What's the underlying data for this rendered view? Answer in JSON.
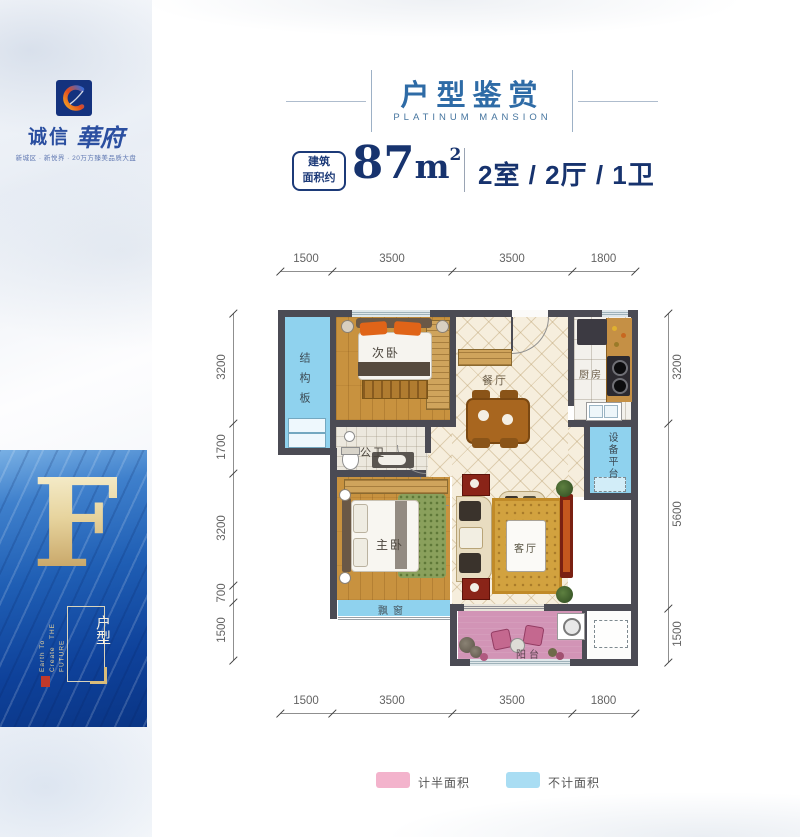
{
  "colors": {
    "navy_text": "#17336e",
    "header_blue": "#2e6ba6",
    "brand_blue": "#2b4fa0",
    "wall_gray": "#4b4b54",
    "room_blue": "#8fd2ee",
    "balcony_pink": "#d294b6",
    "legend_pink": "#f3b3cc",
    "legend_blue": "#a9ddf3",
    "gold": "#d9bc7a"
  },
  "sidebar": {
    "brand_cn_1": "诚信",
    "brand_cn_2": "華府",
    "tagline": "新城区 · 新悦界 · 20万方臻美品质大盘",
    "unit_letter": "F",
    "unit_label": "户型",
    "slogan_en_1": "Earth To Create",
    "slogan_en_2": "THE FUTURE"
  },
  "header": {
    "title": "户型鉴赏",
    "subtitle": "PLATINUM MANSION"
  },
  "summary": {
    "badge_line1": "建筑",
    "badge_line2": "面积约",
    "area_number": "87",
    "area_unit": "m",
    "area_exponent": "2",
    "rooms_text": "2室 / 2厅 / 1卫"
  },
  "floorplan": {
    "rooms": {
      "structure_board": "结构板",
      "second_bedroom": "次卧",
      "dining": "餐厅",
      "kitchen": "厨房",
      "equipment_platform": "设备平台",
      "bathroom": "公卫",
      "master_bedroom": "主卧",
      "living": "客厅",
      "bay_window": "飘窗",
      "balcony": "阳台"
    },
    "dims": {
      "top": [
        "1500",
        "3500",
        "3500",
        "1800"
      ],
      "bottom": [
        "1500",
        "3500",
        "3500",
        "1800"
      ],
      "left": [
        "3200",
        "1700",
        "3200",
        "700",
        "1500"
      ],
      "right": [
        "3200",
        "5600",
        "1500"
      ]
    }
  },
  "legend": {
    "half_area": "计半面积",
    "not_counted": "不计面积"
  }
}
